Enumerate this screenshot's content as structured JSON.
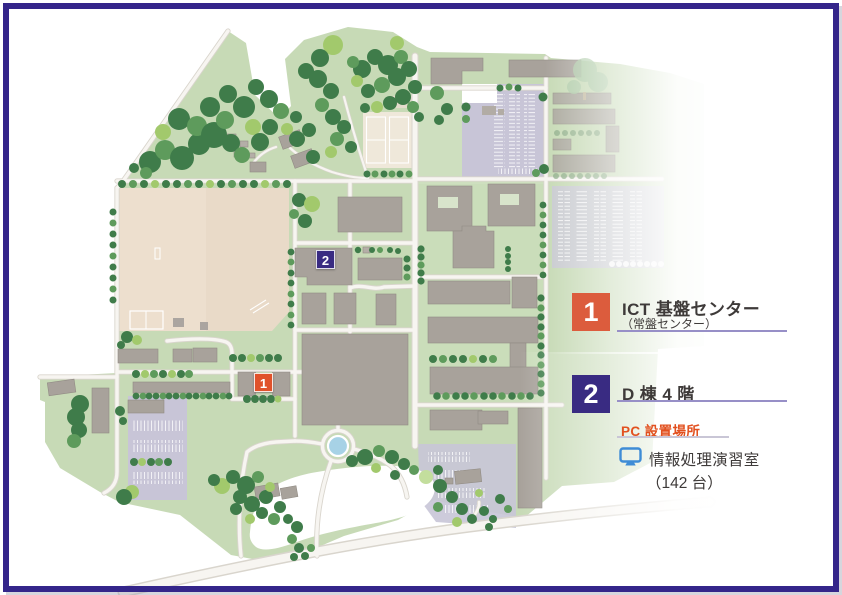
{
  "window": {
    "border_color": "#34258A",
    "background": "#FFFFFF"
  },
  "map": {
    "description": "campus illustration map",
    "markers": [
      {
        "label": "1",
        "color": "#E0522B"
      },
      {
        "label": "2",
        "color": "#392B82"
      }
    ]
  },
  "legend": {
    "items": [
      {
        "number": "1",
        "number_bg": "#DC5C3D",
        "title": "ICT 基盤センター",
        "subtitle": "（常盤センター）",
        "underline_color": "#978FC7"
      },
      {
        "number": "2",
        "number_bg": "#392B82",
        "title": "D 棟 4 階",
        "subtitle": "",
        "underline_color": "#978FC7"
      }
    ],
    "pc_section": {
      "heading": "PC 設置場所",
      "heading_color": "#E2501F",
      "underline_color": "#C9C6D6",
      "icon": "monitor-icon",
      "icon_color": "#3E8CD6",
      "room": "情報処理演習室",
      "capacity": "（142 台）"
    }
  },
  "palette": {
    "ground_green": "#C7DAB6",
    "tree_dark": "#3F7C4A",
    "tree_mid": "#5E9B5C",
    "tree_light": "#A2C96C",
    "building_gray": "#A8A29B",
    "field_beige": "#E9DAC8",
    "parking_lavender": "#C8C5D7",
    "road_white": "#F7F5F1",
    "pond_blue": "#A7D2E6"
  }
}
